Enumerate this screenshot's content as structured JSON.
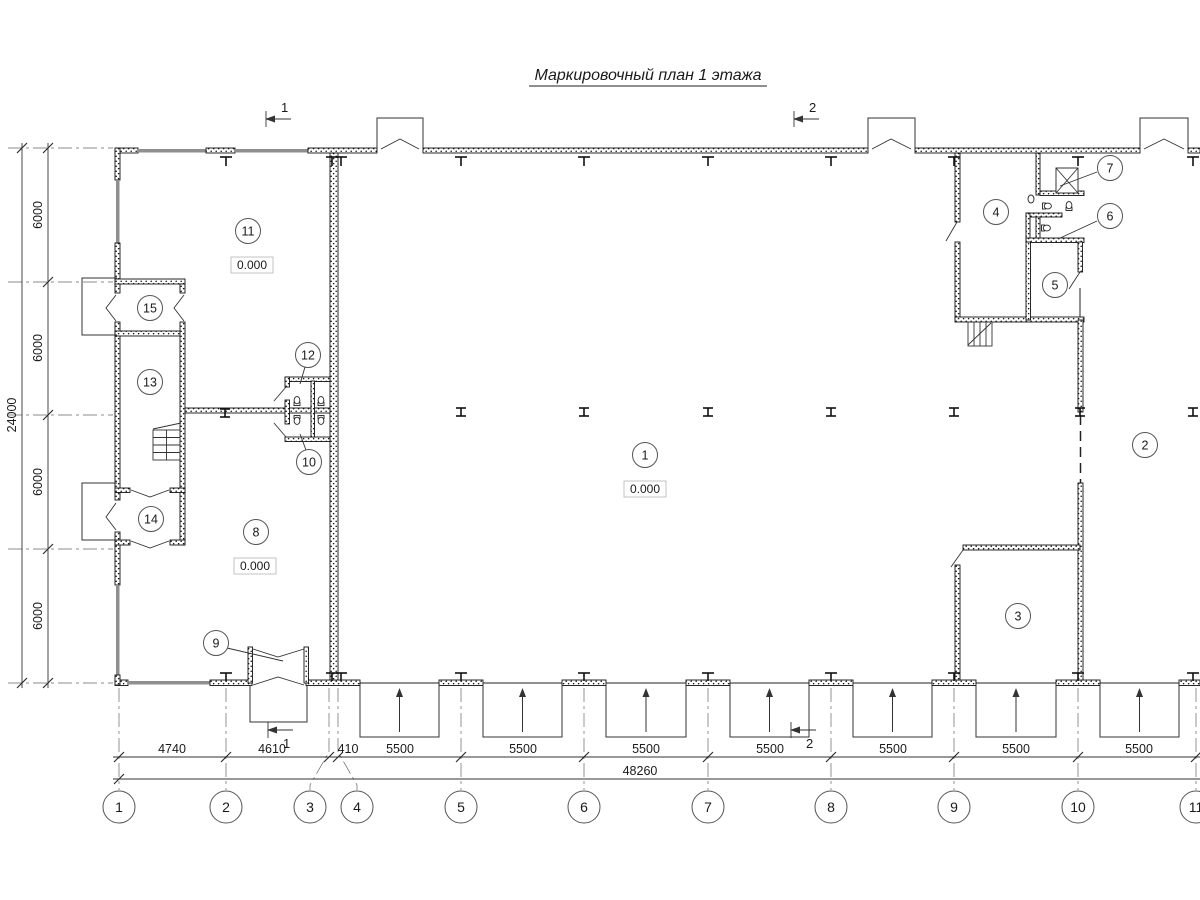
{
  "title": "Маркировочный план 1 этажа",
  "rooms": [
    {
      "label": "1",
      "elevation": "0.000"
    },
    {
      "label": "2"
    },
    {
      "label": "3"
    },
    {
      "label": "4"
    },
    {
      "label": "5"
    },
    {
      "label": "6"
    },
    {
      "label": "7"
    },
    {
      "label": "8",
      "elevation": "0.000"
    },
    {
      "label": "9"
    },
    {
      "label": "10"
    },
    {
      "label": "11",
      "elevation": "0.000"
    },
    {
      "label": "12"
    },
    {
      "label": "13"
    },
    {
      "label": "14"
    },
    {
      "label": "15"
    }
  ],
  "grid": {
    "bubbles": [
      "1",
      "2",
      "3",
      "4",
      "5",
      "6",
      "7",
      "8",
      "9",
      "10",
      "11"
    ]
  },
  "dims": {
    "horizontal": [
      "4740",
      "4610",
      "410",
      "5500",
      "5500",
      "5500",
      "5500",
      "5500",
      "5500",
      "5500"
    ],
    "horizontal_total": "48260",
    "vertical": [
      "6000",
      "6000",
      "6000",
      "6000"
    ],
    "vertical_total": "24000"
  },
  "sections": {
    "s1": "1",
    "s2": "2"
  }
}
